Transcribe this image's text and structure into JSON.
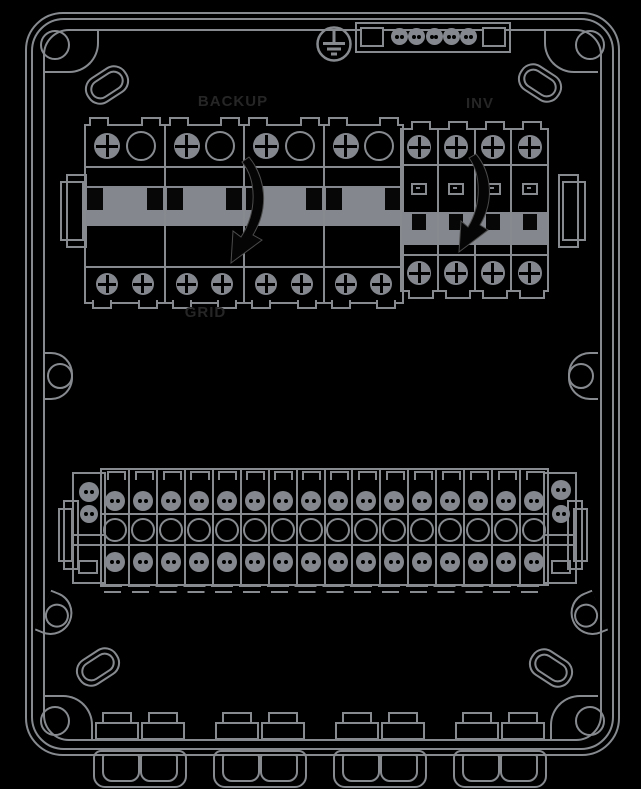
{
  "diagram": {
    "type": "enclosure-internal-layout-drawing",
    "labels": {
      "backup": "BACKUP",
      "inv": "INV",
      "grid": "GRID"
    },
    "breaker_groups": {
      "backup": {
        "label": "BACKUP",
        "poles": 4,
        "terminals_per_pole_top": 2,
        "terminals_per_pole_bottom": 2
      },
      "inv": {
        "label": "INV",
        "poles": 4,
        "terminals_per_pole_top": 1,
        "terminals_per_pole_bottom": 1
      }
    },
    "ground_bar": {
      "screws": 5
    },
    "terminal_strip": {
      "blocks": 16,
      "rows_per_block": 3
    },
    "cable_glands": {
      "groups": 4,
      "glands_per_group": 2
    },
    "corner_screws": 4,
    "vent_slots": 4,
    "mounting_lugs": 4,
    "colors": {
      "background": "#000000",
      "line": "#878b90",
      "fill": "#84888e",
      "handle": "#070707",
      "label_text": "#262626"
    },
    "icons": [
      "ground-screw-icon",
      "screw-terminal-icon",
      "test-button-icon",
      "switch-direction-arrow-icon",
      "corner-screw-icon",
      "vent-slot-icon",
      "mounting-lug-icon",
      "din-rail-end-icon",
      "cable-gland-icon"
    ]
  }
}
